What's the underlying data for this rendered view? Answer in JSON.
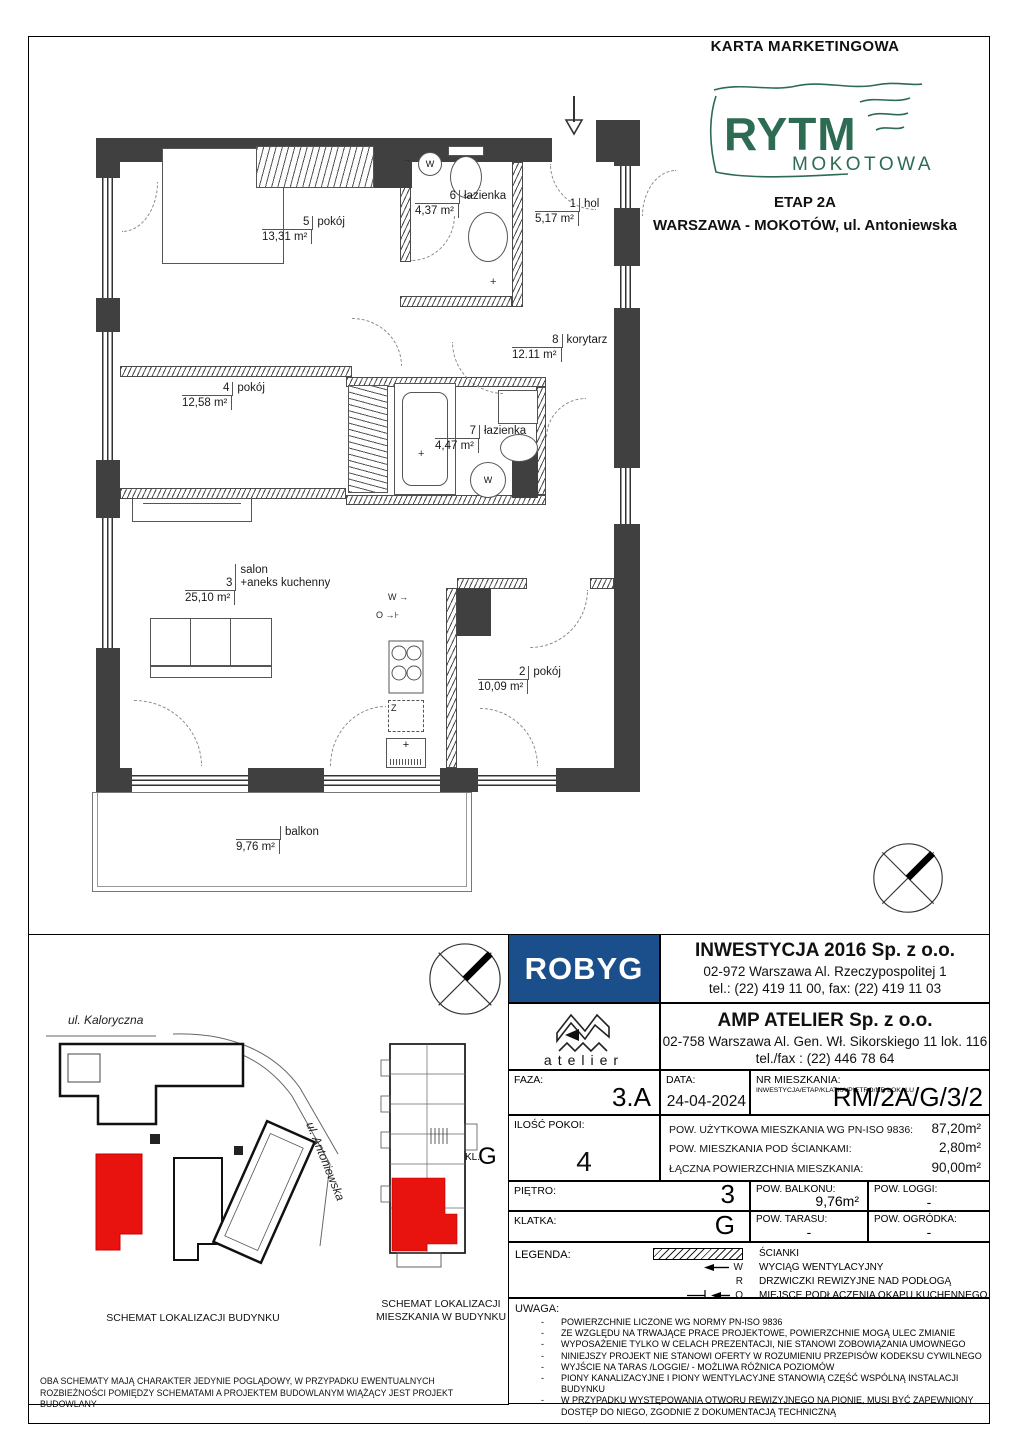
{
  "header": {
    "title": "KARTA MARKETINGOWA",
    "logo": {
      "line1": "RYTM",
      "line2": "MOKOTOWA"
    },
    "stage": "ETAP 2A",
    "location": "WARSZAWA - MOKOTÓW, ul. Antoniewska"
  },
  "floorplan": {
    "rooms": [
      {
        "num": "5",
        "name": "pokój",
        "area": "13,31 m²"
      },
      {
        "num": "6",
        "name": "łazienka",
        "area": "4,37 m²"
      },
      {
        "num": "1",
        "name": "hol",
        "area": "5,17 m²"
      },
      {
        "num": "8",
        "name": "korytarz",
        "area": "12.11 m²"
      },
      {
        "num": "4",
        "name": "pokój",
        "area": "12,58 m²"
      },
      {
        "num": "7",
        "name": "łazienka",
        "area": "4,47 m²"
      },
      {
        "num": "3",
        "pre": "salon",
        "name": "+aneks kuchenny",
        "area": "25,10 m²"
      },
      {
        "num": "2",
        "name": "pokój",
        "area": "10,09 m²"
      },
      {
        "num": "",
        "name": "balkon",
        "area": "9,76 m²"
      }
    ],
    "symbols": {
      "vent": "W",
      "hood": "O",
      "fridge": "Z"
    }
  },
  "developer": {
    "name": "ROBYG",
    "company": "INWESTYCJA 2016 Sp. z o.o.",
    "address": "02-972 Warszawa Al. Rzeczypospolitej 1",
    "phones": "tel.: (22) 419 11 00, fax: (22) 419 11 03"
  },
  "architect": {
    "name": "atelier",
    "company": "AMP ATELIER Sp. z o.o.",
    "address": "02-758 Warszawa Al. Gen. Wł. Sikorskiego 11 lok. 116",
    "phones": "tel./fax : (22) 446 78 64"
  },
  "details": {
    "faza_label": "FAZA:",
    "faza": "3.A",
    "data_label": "DATA:",
    "data": "24-04-2024",
    "nr_label": "NR MIESZKANIA:",
    "nr_caption": "INWESTYCJA/ETAP/KLATKA/PIĘTRO/NR LOKALU",
    "nr": "RM/2A/G/3/2",
    "rooms_label": "ILOŚĆ POKOI:",
    "rooms": "4",
    "area_rows": [
      {
        "label": "POW. UŻYTKOWA MIESZKANIA WG PN-ISO 9836:",
        "value": "87,20m²"
      },
      {
        "label": "POW. MIESZKANIA POD ŚCIANKAMI:",
        "value": "2,80m²"
      },
      {
        "label": "ŁĄCZNA POWIERZCHNIA MIESZKANIA:",
        "value": "90,00m²"
      }
    ],
    "pietro_label": "PIĘTRO:",
    "pietro": "3",
    "balkon_label": "POW. BALKONU:",
    "balkon": "9,76m²",
    "loggi_label": "POW. LOGGI:",
    "loggi": "-",
    "klatka_label": "KLATKA:",
    "klatka": "G",
    "taras_label": "POW. TARASU:",
    "taras": "-",
    "ogrodek_label": "POW. OGRÓDKA:",
    "ogrodek": "-"
  },
  "legend": {
    "label": "LEGENDA:",
    "symbols": {
      "w": "W",
      "r": "R",
      "o": "O"
    },
    "items": [
      "ŚCIANKI",
      "WYCIĄG WENTYLACYJNY",
      "DRZWICZKI REWIZYJNE NAD PODŁOGĄ",
      "MIEJSCE PODŁACZENIA OKAPU KUCHENNEGO"
    ]
  },
  "uwaga": {
    "label": "UWAGA:",
    "items": [
      "POWIERZCHNIE LICZONE WG NORMY PN-ISO 9836",
      "ZE WZGLĘDU NA TRWAJĄCE PRACE PROJEKTOWE, POWIERZCHNIE MOGĄ ULEC ZMIANIE",
      "WYPOSAŻENIE TYLKO W CELACH PREZENTACJI, NIE STANOWI ZOBOWIĄZANIA UMOWNEGO",
      "NINIEJSZY PROJEKT NIE STANOWI OFERTY W ROZUMIENIU PRZEPISÓW KODEKSU CYWILNEGO",
      "WYJŚCIE NA TARAS /LOGGIE/ - MOŻLIWA RÓŻNICA POZIOMÓW",
      "PIONY KANALIZACYJNE I PIONY WENTYLACYJNE STANOWIĄ CZĘŚĆ WSPÓLNĄ INSTALACJI BUDYNKU",
      "W PRZYPADKU WYSTĘPOWANIA OTWORU REWIZYJNEGO NA PIONIE, MUSI BYĆ ZAPEWNIONY DOSTĘP DO NIEGO, ZGODNIE Z DOKUMENTACJĄ TECHNICZNĄ"
    ]
  },
  "schematics": {
    "street_top": "ul. Kaloryczna",
    "street_right": "ul. Antoniewska",
    "stair_label": "KL.",
    "stair": "G",
    "caption_building": "SCHEMAT LOKALIZACJI BUDYNKU",
    "caption_flat": "SCHEMAT LOKALIZACJI MIESZKANIA W BUDYNKU",
    "disclaimer": "OBA SCHEMATY MAJĄ CHARAKTER JEDYNIE POGLĄDOWY, W PRZYPADKU EWENTUALNYCH ROZBIEŻNOŚCI POMIĘDZY SCHEMATAMI A PROJEKTEM BUDOWLANYM WIĄŻĄCY JEST PROJEKT BUDOWLANY"
  },
  "colors": {
    "brand_green": "#2d6b53",
    "robyg_blue": "#1a4f8c",
    "highlight_red": "#e8120e",
    "wall": "#404040"
  }
}
